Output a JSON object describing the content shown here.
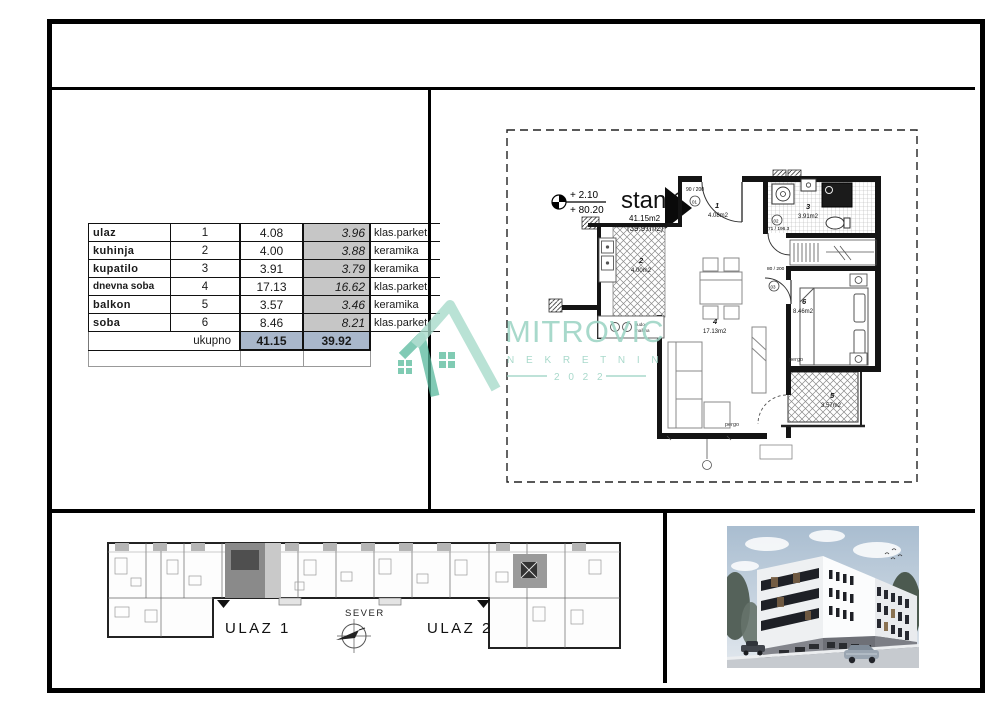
{
  "table": {
    "rows": [
      {
        "name": "ulaz",
        "num": "1",
        "gross": "4.08",
        "net": "3.96",
        "floor": "klas.parket"
      },
      {
        "name": "kuhinja",
        "num": "2",
        "gross": "4.00",
        "net": "3.88",
        "floor": "keramika"
      },
      {
        "name": "kupatilo",
        "num": "3",
        "gross": "3.91",
        "net": "3.79",
        "floor": "keramika"
      },
      {
        "name": "dnevna soba",
        "num": "4",
        "gross": "17.13",
        "net": "16.62",
        "floor": "klas.parket"
      },
      {
        "name": "balkon",
        "num": "5",
        "gross": "3.57",
        "net": "3.46",
        "floor": "keramika"
      },
      {
        "name": "soba",
        "num": "6",
        "gross": "8.46",
        "net": "8.21",
        "floor": "klas.parket"
      }
    ],
    "total": {
      "label": "ukupno",
      "gross": "41.15",
      "net": "39.92"
    },
    "colors": {
      "net_column_bg": "#c6c6c6",
      "total_row_bg": "#a9b7cb"
    }
  },
  "floorplan": {
    "unit_title": "stan 1",
    "area_gross": "41.15m2",
    "area_net": "(39.91m2)",
    "elevation_top": "+ 2.10",
    "elevation_bottom": "+ 80.20",
    "rooms": [
      {
        "num": "1",
        "area": "4.08m2"
      },
      {
        "num": "2",
        "area": "4.00m2"
      },
      {
        "num": "3",
        "area": "3.91m2"
      },
      {
        "num": "4",
        "area": "17.13m2"
      },
      {
        "num": "5",
        "area": "3.57m2"
      },
      {
        "num": "6",
        "area": "8.46m2"
      }
    ],
    "doors": {
      "entry_dim": "90 / 200",
      "entry_tag": "01",
      "bath_dim": "71 / 196.3",
      "bath_tag": "02",
      "bedroom_dim": "80 / 200",
      "bedroom_tag": "03"
    },
    "pergola_label": "pergo",
    "kitchen_note_line1": "sudo-",
    "kitchen_note_line2": "mašina"
  },
  "site_plan": {
    "entrance1": "ULAZ 1",
    "entrance2": "ULAZ 2",
    "north_label": "SEVER"
  },
  "logo": {
    "brand": "MITROVIC",
    "subtitle": "N E K R E T N I N E",
    "year": "2 0 2 2",
    "color_light": "#9dd4c4",
    "color_dark": "#57b89c"
  }
}
